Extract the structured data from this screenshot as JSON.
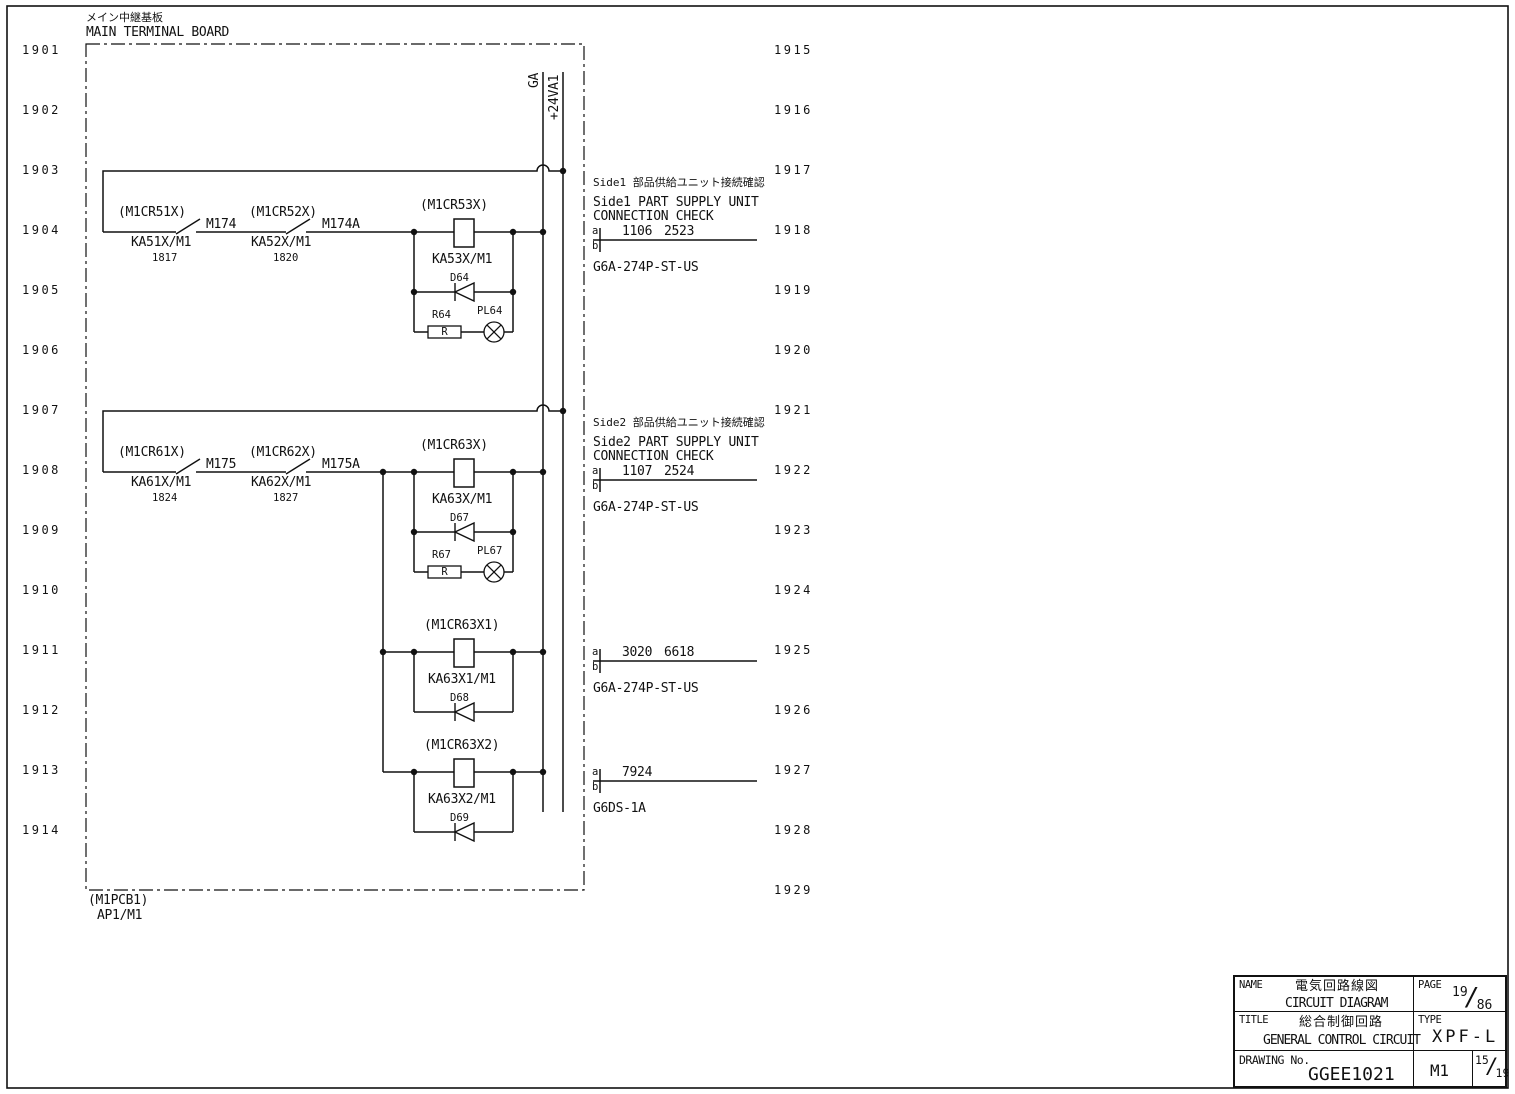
{
  "header": {
    "board_name_jp": "メイン中継基板",
    "board_name_en": "MAIN TERMINAL BOARD"
  },
  "footer": {
    "ref": "(M1PCB1)",
    "name": "AP1/M1"
  },
  "buses": {
    "ga": "GA",
    "p24": "+24VA1"
  },
  "left_line_numbers": [
    "1901",
    "1902",
    "1903",
    "1904",
    "1905",
    "1906",
    "1907",
    "1908",
    "1909",
    "1910",
    "1911",
    "1912",
    "1913",
    "1914"
  ],
  "right_line_numbers": [
    "1915",
    "1916",
    "1917",
    "1918",
    "1919",
    "1920",
    "1921",
    "1922",
    "1923",
    "1924",
    "1925",
    "1926",
    "1927",
    "1928",
    "1929"
  ],
  "rungs": {
    "r1": {
      "c1_ref": "(M1CR51X)",
      "c1_name": "KA51X/M1",
      "c1_pin": "1817",
      "w1": "M174",
      "c2_ref": "(M1CR52X)",
      "c2_name": "KA52X/M1",
      "c2_pin": "1820",
      "w2": "M174A",
      "coil_ref": "(M1CR53X)",
      "coil_name": "KA53X/M1",
      "diode": "D64",
      "res": "R64",
      "res_sym": "R",
      "lamp": "PL64"
    },
    "r2": {
      "c1_ref": "(M1CR61X)",
      "c1_name": "KA61X/M1",
      "c1_pin": "1824",
      "w1": "M175",
      "c2_ref": "(M1CR62X)",
      "c2_name": "KA62X/M1",
      "c2_pin": "1827",
      "w2": "M175A",
      "coil_ref": "(M1CR63X)",
      "coil_name": "KA63X/M1",
      "diode": "D67",
      "res": "R67",
      "res_sym": "R",
      "lamp": "PL67"
    },
    "r3": {
      "coil_ref": "(M1CR63X1)",
      "coil_name": "KA63X1/M1",
      "diode": "D68"
    },
    "r4": {
      "coil_ref": "(M1CR63X2)",
      "coil_name": "KA63X2/M1",
      "diode": "D69"
    }
  },
  "annotations": {
    "b1": {
      "jp": "Side1 部品供給ユニット接続確認",
      "en1": "Side1 PART SUPPLY UNIT",
      "en2": "CONNECTION CHECK",
      "a": "a",
      "b": "b",
      "t1": "1106",
      "t2": "2523",
      "part": "G6A-274P-ST-US"
    },
    "b2": {
      "jp": "Side2 部品供給ユニット接続確認",
      "en1": "Side2 PART SUPPLY UNIT",
      "en2": "CONNECTION CHECK",
      "a": "a",
      "b": "b",
      "t1": "1107",
      "t2": "2524",
      "part": "G6A-274P-ST-US"
    },
    "b3": {
      "a": "a",
      "b": "b",
      "t1": "3020",
      "t2": "6618",
      "part": "G6A-274P-ST-US"
    },
    "b4": {
      "a": "a",
      "b": "b",
      "t1": "7924",
      "part": "G6DS-1A"
    }
  },
  "title_block": {
    "name_label": "NAME",
    "name_jp": "電気回路線図",
    "name_en": "CIRCUIT DIAGRAM",
    "page_label": "PAGE",
    "page_num": "19",
    "page_total": "86",
    "title_label": "TITLE",
    "title_jp": "総合制御回路",
    "title_en": "GENERAL CONTROL CIRCUIT",
    "type_label": "TYPE",
    "type_value": "XPF-L",
    "drawing_label": "DRAWING No.",
    "drawing_value": "GGEE1021",
    "unit": "M1",
    "sheet_num": "15",
    "sheet_total": "19"
  }
}
